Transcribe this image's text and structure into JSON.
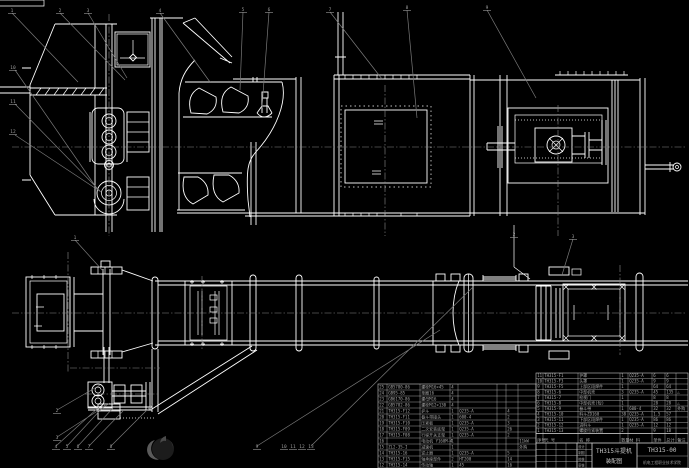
{
  "meta": {
    "background_color": "#000000",
    "line_color": "#ffffff",
    "leader_color": "#7a7a7a",
    "centerline_color": "#8a8a8a",
    "table_grid_color": "#c9c9c9",
    "small_text_color": "#a8a8a8",
    "title_text_color": "#c6c6c6",
    "watermark_body_color": "#1c1c1c",
    "watermark_crescent_color": "#5a5a5a"
  },
  "title_block": {
    "product": "TH315斗提机",
    "doc_type": "装配图",
    "drawing_no": "TH315-00",
    "organization": "机电工程职业技术学院",
    "sig_labels": [
      "设计",
      "制图",
      "校核",
      "审核"
    ]
  },
  "bom_header": [
    "序号",
    "代 号",
    "名 称",
    "数量",
    "材 料",
    "单件",
    "总计",
    "备注"
  ],
  "bom_right": {
    "rows": [
      [
        "11",
        "TH315-F1",
        "护罩",
        "1",
        "Q235-A",
        "6",
        "6",
        ""
      ],
      [
        "10",
        "TH315-F3",
        "头罩",
        "1",
        "Q235-A",
        "9",
        "9",
        ""
      ],
      [
        "9",
        "TH315-F5",
        "上部区段焊件",
        "1",
        "",
        "64",
        "64",
        ""
      ],
      [
        "8",
        "TH315-6",
        "中部机壳",
        "3",
        "Q235-A",
        "45",
        "135",
        "△"
      ],
      [
        "7",
        "TH315-7",
        "检视门",
        "1",
        "",
        "8",
        "8",
        ""
      ],
      [
        "6",
        "TH315-8",
        "中部机壳(短)",
        "1",
        "",
        "28",
        "28",
        "△"
      ],
      [
        "5",
        "TH315-9",
        "畚斗带",
        "1",
        "600-4",
        "32",
        "32",
        "外购"
      ],
      [
        "4",
        "TH315-10",
        "料斗ZD160",
        "38",
        "Q235-A",
        "1.5",
        "57",
        ""
      ],
      [
        "3",
        "TH315-11",
        "下部区段焊件",
        "1",
        "Q235-A",
        "86",
        "86",
        ""
      ],
      [
        "2",
        "TH315-12",
        "进料斗",
        "1",
        "Q235-A",
        "12",
        "12",
        ""
      ],
      [
        "1",
        "TH315-13",
        "螺旋拉紧装置",
        "2",
        "",
        "9",
        "18",
        ""
      ]
    ]
  },
  "bom_left": {
    "rows": [
      [
        "25",
        "GB5780-86",
        "螺栓M16×45",
        "4",
        "",
        "",
        "",
        ""
      ],
      [
        "24",
        "GB95-85",
        "垫圈16",
        "4",
        "",
        "",
        "",
        ""
      ],
      [
        "23",
        "GB6170-86",
        "螺母M16",
        "4",
        "",
        "",
        "",
        ""
      ],
      [
        "22",
        "GB5782-86",
        "螺栓M12×130",
        "4",
        "",
        "",
        "",
        ""
      ],
      [
        "21",
        "TH315-F12",
        "护斗",
        "1",
        "Q235-A",
        "",
        "4",
        ""
      ],
      [
        "20",
        "TH315-F11",
        "畚斗带接头",
        "1",
        "600-4",
        "",
        "2",
        ""
      ],
      [
        "19",
        "TH315-F10",
        "压紧板",
        "1",
        "Q235-A",
        "",
        "3",
        ""
      ],
      [
        "18",
        "TH315-F09",
        "二次安装底架",
        "1",
        "Q235-A",
        "",
        "26",
        ""
      ],
      [
        "17",
        "TH315-F08",
        "行程开关支架",
        "1",
        "Q235-A",
        "",
        "2",
        ""
      ],
      [
        "16",
        "",
        "电动机 Y160M-4",
        "1",
        "",
        "",
        "",
        "11kW"
      ],
      [
        "15",
        "ZL2-35-I",
        "减速机",
        "1",
        "",
        "",
        "",
        "外购"
      ],
      [
        "14",
        "TH315-16",
        "逆止器",
        "1",
        "Q235-A",
        "",
        "5",
        ""
      ],
      [
        "13",
        "TH315-F15",
        "轴承座部件",
        "2",
        "HT200",
        "",
        "14",
        ""
      ],
      [
        "12",
        "TH315-14",
        "传动轴",
        "1",
        "45",
        "",
        "16",
        ""
      ]
    ]
  },
  "balloons": [
    {
      "n": "1",
      "x": 12,
      "y": 10
    },
    {
      "n": "2",
      "x": 60,
      "y": 10
    },
    {
      "n": "3",
      "x": 88,
      "y": 10
    },
    {
      "n": "4",
      "x": 160,
      "y": 10
    },
    {
      "n": "5",
      "x": 243,
      "y": 9
    },
    {
      "n": "6",
      "x": 269,
      "y": 9
    },
    {
      "n": "7",
      "x": 330,
      "y": 9
    },
    {
      "n": "8",
      "x": 407,
      "y": 7
    },
    {
      "n": "9",
      "x": 487,
      "y": 7
    },
    {
      "n": "10",
      "x": 13,
      "y": 67
    },
    {
      "n": "11",
      "x": 13,
      "y": 101
    },
    {
      "n": "12",
      "x": 13,
      "y": 131
    },
    {
      "n": "1",
      "x": 75,
      "y": 237
    },
    {
      "n": "2",
      "x": 514,
      "y": 234
    },
    {
      "n": "3",
      "x": 573,
      "y": 236
    },
    {
      "n": "2",
      "x": 57,
      "y": 410
    },
    {
      "n": "3",
      "x": 57,
      "y": 437
    },
    {
      "n": "4",
      "x": 56,
      "y": 446
    },
    {
      "n": "5",
      "x": 67,
      "y": 446
    },
    {
      "n": "6",
      "x": 78,
      "y": 446
    },
    {
      "n": "7",
      "x": 89,
      "y": 446
    },
    {
      "n": "8",
      "x": 111,
      "y": 446
    },
    {
      "n": "9",
      "x": 257,
      "y": 446
    },
    {
      "n": "10",
      "x": 284,
      "y": 446
    },
    {
      "n": "11",
      "x": 293,
      "y": 446
    },
    {
      "n": "12",
      "x": 302,
      "y": 446
    },
    {
      "n": "13",
      "x": 311,
      "y": 446
    }
  ]
}
